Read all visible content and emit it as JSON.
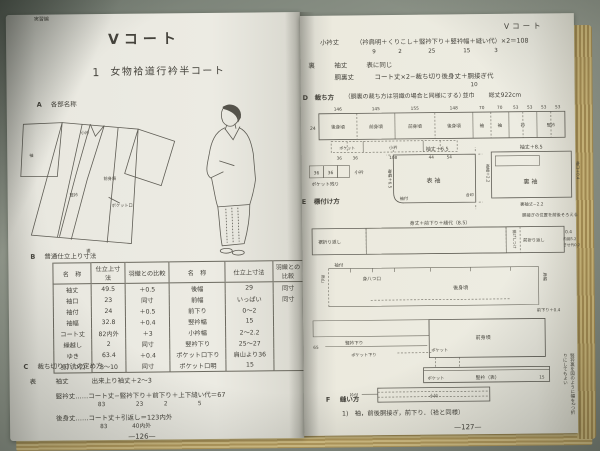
{
  "book": {
    "left_page": {
      "edition": "実習編",
      "title": "Vコート",
      "section1": {
        "num": "1",
        "title": "女物袷道行衿半コート"
      },
      "sectionA": {
        "label": "A",
        "title": "各部名称"
      },
      "diagram": {
        "labels": [
          "小衿",
          "袖",
          "竪衿",
          "前身頃",
          "ポケット口",
          "裾"
        ]
      },
      "sectionB": {
        "label": "B",
        "title": "普通仕立上り寸法"
      },
      "tableB": {
        "headers": [
          "名　称",
          "仕立上寸法",
          "羽織との比較",
          "名　称",
          "仕立上寸法",
          "羽織との比較"
        ],
        "rows": [
          [
            "袖丈",
            "49.5",
            "＋0.5",
            "後幅",
            "29",
            "同寸"
          ],
          [
            "袖口",
            "23",
            "同寸",
            "前幅",
            "いっぱい",
            "同寸"
          ],
          [
            "袖付",
            "24",
            "＋0.5",
            "前下り",
            "0〜2",
            ""
          ],
          [
            "袖幅",
            "32.8",
            "＋0.4",
            "竪衿幅",
            "15",
            ""
          ],
          [
            "コート丈",
            "82内外",
            "＋3",
            "小衿幅",
            "2〜2.2",
            ""
          ],
          [
            "繰越し",
            "2",
            "同寸",
            "竪衿下り",
            "25〜27",
            ""
          ],
          [
            "ゆき",
            "63.4",
            "＋0.4",
            "ポケット口下り",
            "肩山より36",
            ""
          ],
          [
            "身八つ口",
            "8〜10",
            "同寸",
            "ポケット口明",
            "15",
            ""
          ]
        ]
      },
      "sectionC": {
        "label": "C",
        "title": "裁ち切り寸法の定め方",
        "line1_prefix": "表",
        "line1_name": "袖丈",
        "line1_formula": "出来上り袖丈＋2〜3",
        "line2": "竪衿丈……コート丈−竪衿下り＋前下り＋上下縫い代＝67",
        "line2_nums": [
          "83",
          "23",
          "2",
          "5"
        ],
        "line3": "後身丈……コート丈＋引返し＝123内外",
        "line3_nums": [
          "83",
          "40内外"
        ]
      },
      "page_number": "—126—"
    },
    "right_page": {
      "running_head": "Vコート",
      "kokeri_name": "小衿丈",
      "kokeri_formula": "（衿肩明＋くりこし＋竪衿下り＋竪衿幅＋縫い代）×2＝108",
      "kokeri_nums": [
        "9",
        "2",
        "25",
        "15",
        "3"
      ],
      "lining_label": "裏",
      "lining_sode": "袖丈",
      "lining_sode_val": "表に同じ",
      "lining_do": "胴裏丈",
      "lining_do_formula": "コート丈×2−裁ち切り後身丈＋胴接ぎ代",
      "lining_do_num": "10",
      "sectionD": {
        "label": "D",
        "title": "裁ち方",
        "note": "（胴裏の裁ち方は羽織の場合と同様にする）",
        "width": "並巾",
        "total": "総丈922cm"
      },
      "fabric": {
        "width_label": "24",
        "measures": [
          "146",
          "145",
          "155",
          "148",
          "70",
          "70",
          "53",
          "53",
          "53",
          "53"
        ],
        "pieces": [
          "後身頃",
          "前身頃",
          "前身頃",
          "後身頃",
          "袖",
          "袖",
          "衿",
          "竪衿"
        ],
        "sub_labels": [
          "ポケット",
          "小衿"
        ],
        "sub_nums": [
          "36",
          "36",
          "108",
          "44",
          "54"
        ]
      },
      "scraps": {
        "n1": "36",
        "n2": "36",
        "label": "小衿",
        "caption": "ポケット残り"
      },
      "sectionE": {
        "label": "E",
        "title": "標付け方"
      },
      "sleeve_front": {
        "top": "袖丈＋6.5",
        "left": "袖幅＋6.5",
        "center": "表袖",
        "bottom": "袖付",
        "right": "合印"
      },
      "sleeve_lining": {
        "top": "袖丈＋8.5",
        "left": "袖幅＋2.2",
        "center": "裏袖",
        "bottom": "裏袖丈−2.2",
        "right": "袖口＋0.4",
        "note": "胴接ぎの位置を前後そろえる"
      },
      "marking": {
        "strip1_top": "身丈＋前下り＋縫代（8.5）",
        "strip1_left": "裾折り返し",
        "strip1_vert": "揚げしつけ",
        "strip1_right": "前折り返し",
        "strip1_val": "0.4",
        "strip1_brace1": "内揚5.2",
        "strip1_brace2": "きせ代0.2",
        "strip2_sodetsuke": "袖付",
        "strip2_miyatsu": "身八つ口",
        "strip2_ushiro": "後身頃",
        "strip2_katahaba": "肩幅",
        "strip2_maesagari": "前下り＋0.4",
        "strip2_katayama": "肩山",
        "strip3_tateerisagari": "竪衿下り",
        "strip3_pocketsagari": "ポケット下り",
        "strip3_pocket": "ポケット",
        "strip3_maemigoro": "前身頃",
        "strip3_num": "65",
        "collar_pocket": "ポケット",
        "collar_name": "竪衿（表）",
        "collar_num": "15",
        "collar_note": "竪衿裏を図のように幅を2つ折りにしてもよい",
        "kokeri_label": "小衿",
        "kokeri_left": "衿付"
      },
      "sectionF": {
        "label": "F",
        "title": "縫い方",
        "item1": "1)　袖，前後胴接ぎ，前下り．（袷と同様）"
      },
      "page_number": "—127—"
    }
  }
}
